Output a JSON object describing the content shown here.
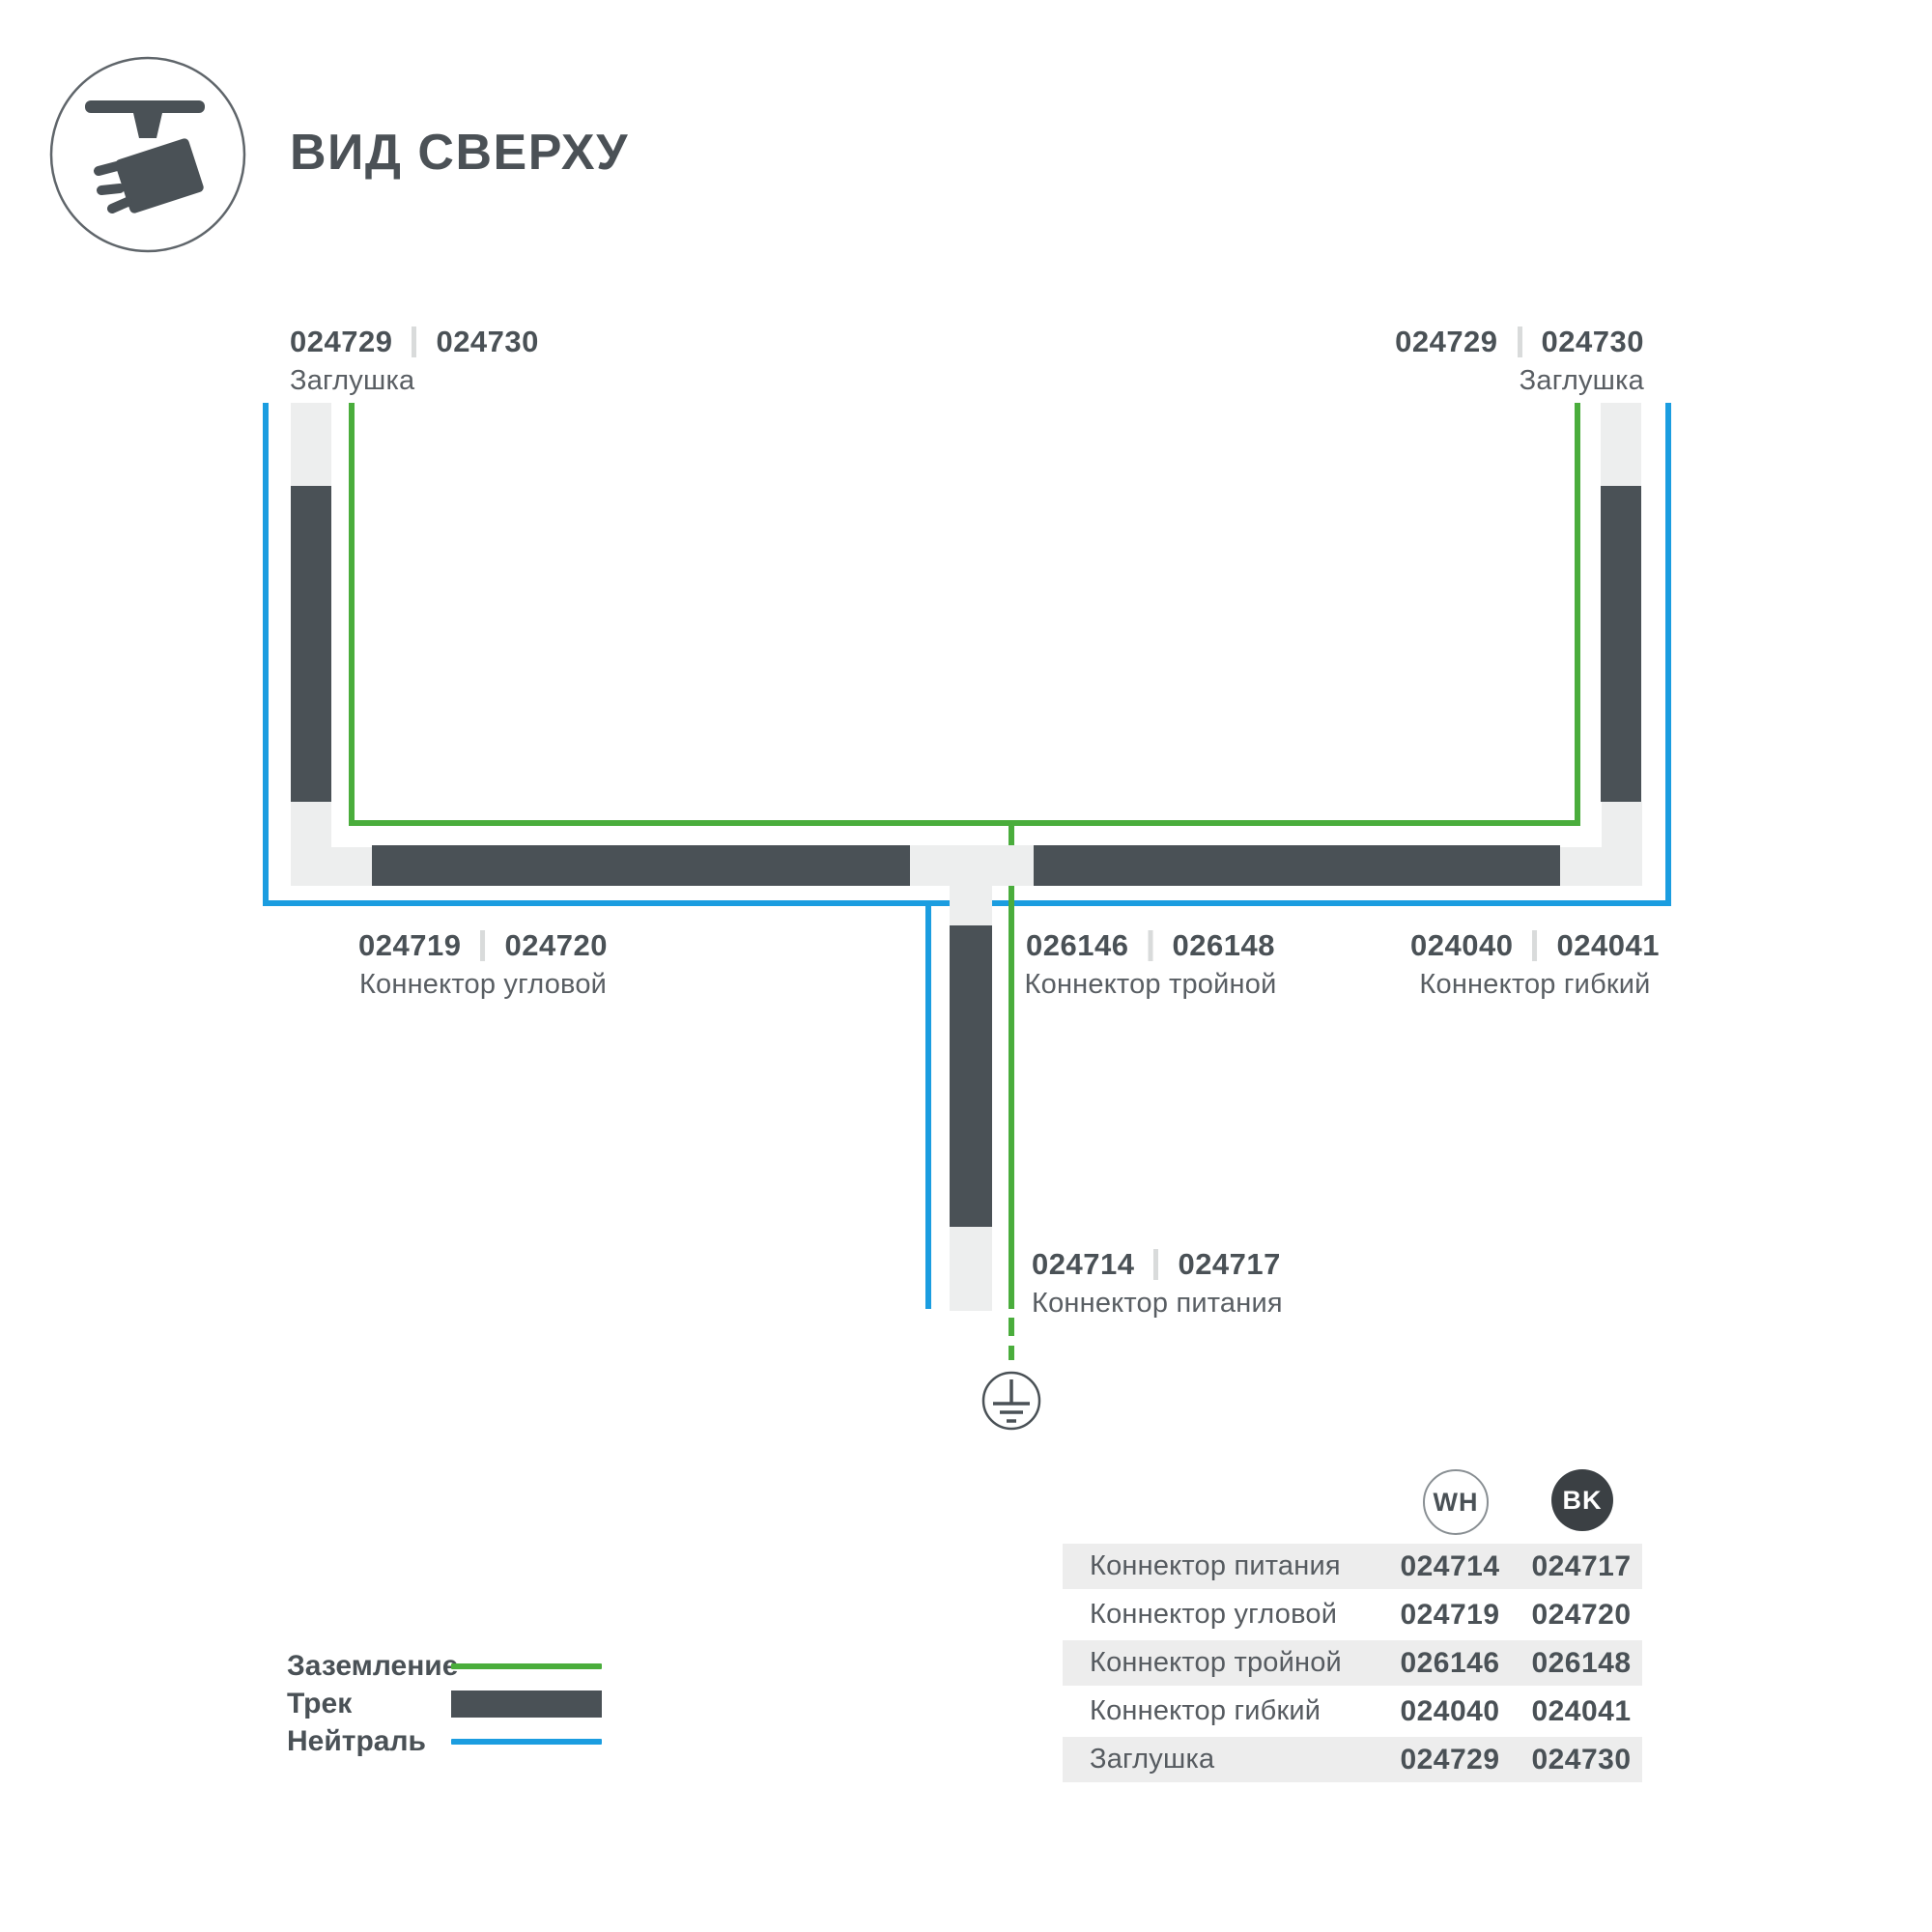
{
  "header": {
    "title": "ВИД СВЕРХУ"
  },
  "colors": {
    "ground_green": "#4aad3c",
    "neutral_blue": "#1b9de0",
    "track_dark": "#4a5156",
    "connector_light": "#edeeee",
    "table_row_gray": "#ededed",
    "bk_badge": "#3b4044"
  },
  "diagram": {
    "labels": {
      "endcap_left": {
        "wh": "024729",
        "bk": "024730",
        "name": "Заглушка"
      },
      "endcap_right": {
        "wh": "024729",
        "bk": "024730",
        "name": "Заглушка"
      },
      "corner": {
        "wh": "024719",
        "bk": "024720",
        "name": "Коннектор угловой"
      },
      "triple": {
        "wh": "026146",
        "bk": "026148",
        "name": "Коннектор тройной"
      },
      "flexible": {
        "wh": "024040",
        "bk": "024041",
        "name": "Коннектор гибкий"
      },
      "power": {
        "wh": "024714",
        "bk": "024717",
        "name": "Коннектор питания"
      }
    }
  },
  "legend": {
    "items": [
      {
        "label": "Заземление",
        "swatch": "line",
        "color": "#4aad3c"
      },
      {
        "label": "Трек",
        "swatch": "bar",
        "color": "#4a5156"
      },
      {
        "label": "Нейтраль",
        "swatch": "line",
        "color": "#1b9de0"
      }
    ]
  },
  "table": {
    "columns": [
      {
        "id": "wh",
        "label": "WH"
      },
      {
        "id": "bk",
        "label": "BK"
      }
    ],
    "rows": [
      {
        "name": "Коннектор питания",
        "wh": "024714",
        "bk": "024717"
      },
      {
        "name": "Коннектор угловой",
        "wh": "024719",
        "bk": "024720"
      },
      {
        "name": "Коннектор тройной",
        "wh": "026146",
        "bk": "026148"
      },
      {
        "name": "Коннектор гибкий",
        "wh": "024040",
        "bk": "024041"
      },
      {
        "name": "Заглушка",
        "wh": "024729",
        "bk": "024730"
      }
    ]
  }
}
